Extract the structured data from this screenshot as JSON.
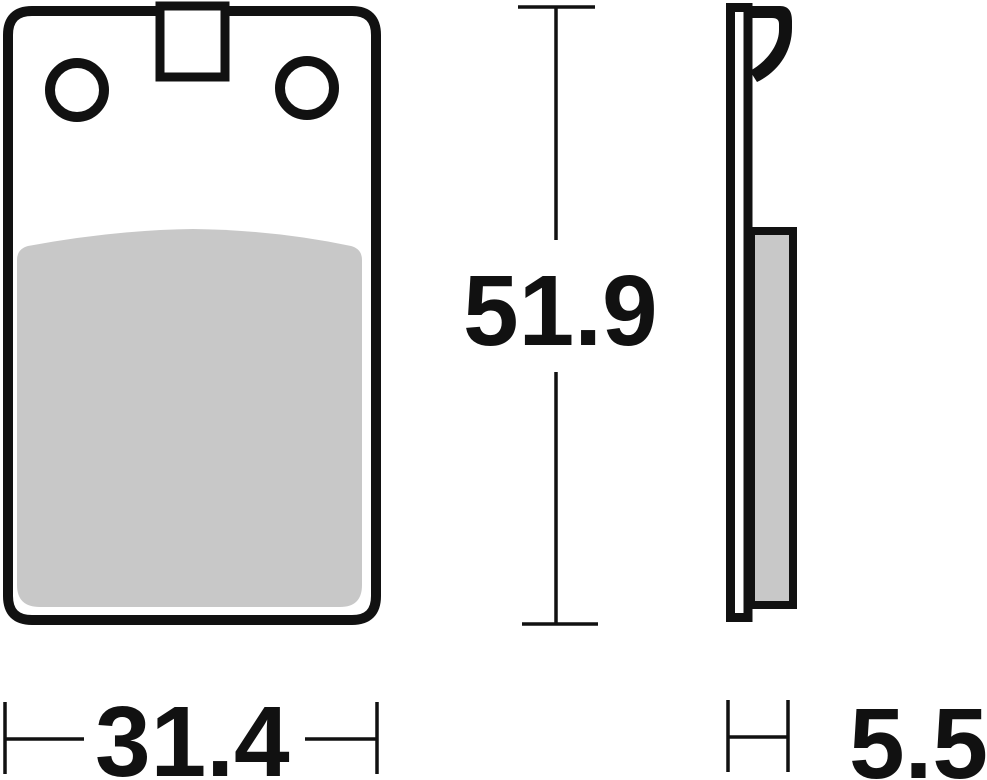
{
  "drawing": {
    "dimension_labels": {
      "width": "31.4",
      "height": "51.9",
      "thickness": "5.5"
    },
    "colors": {
      "line": "#111111",
      "friction_material": "#c8c8c8",
      "background": "#ffffff"
    }
  }
}
